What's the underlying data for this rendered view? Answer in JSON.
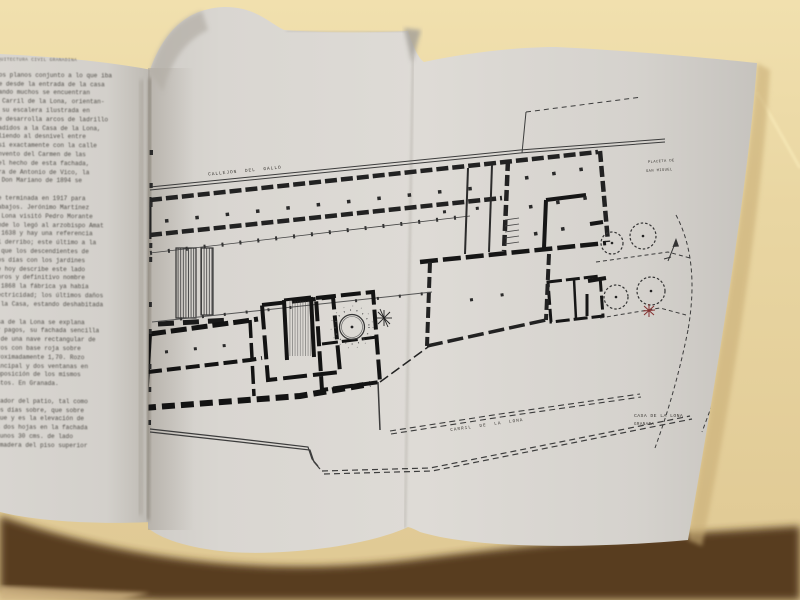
{
  "palette": {
    "table_beige": "#e9d6a2",
    "table_beige_light": "#f0dfae",
    "table_beige_dark": "#cdb181",
    "page_white": "#d8d5d0",
    "page_shadow_brown": "#4e3119",
    "ink": "#1f1f1f",
    "plan_thin_line": "#3c3c3c",
    "red_mark": "#833030"
  },
  "left_page": {
    "running_header": "ARQUITECTURA CIVIL GRANADINA",
    "paragraphs": [
      [
        "chos planos conjunto a lo que iba",
        "que desde la entrada de la casa",
        "cuando muchos se encuentran",
        "al Carril de la Lona, orientan-",
        "do su escalera ilustrada en",
        "que desarrolla arcos de ladrillo",
        "añadidos a la Casa de la Lona,",
        "saliendo al desnivel entre",
        "casi exactamente con la calle",
        "convento del Carmen de las",
        "y el hecho de esta fachada,",
        "obra de Antonio de Vico, la",
        "de Don Mariano de 1894 se"
      ],
      [
        "fue terminada en 1917 para",
        "trabajos. Jerónimo Martínez",
        "la Lona visitó Pedro Morante",
        "donde lo legó al arzobispo Amat",
        "de 1638 y hay una referencia",
        "del derribo; este último a la",
        "en que los descendientes de",
        "unos días con los jardines",
        "que hoy describe este lado",
        "libros y definitivo nombre",
        "de 1868 la fábrica ya había",
        "electricidad; los últimos daños",
        "de la Casa, estando deshabitada"
      ],
      [
        "Casa de la Lona se explana",
        "por pagos, su fachada sencilla",
        "es de una nave rectangular de",
        "muros con base roja sobre",
        "aproximadamente 1,70. Rozo",
        "principal y dos ventanas en",
        "composición de los mismos",
        "restos. En Granada."
      ],
      [
        "mirador del patio, tal como",
        "esos días sobre, que sobre",
        "sigue y es la elevación de",
        "las dos hojas en la fachada",
        "de unos 30 cms. de lado",
        "la madera del piso superior"
      ]
    ]
  },
  "plan": {
    "labels": {
      "top_street": "CALLEJON DEL GALLO",
      "upper_right_line1": "PLACETA DE",
      "upper_right_line2": "SAN MIGUEL",
      "bottom_street": "CARRIL DE LA LONA",
      "title_line1": "CASA DE LA LONA",
      "title_line2": "GRANADA"
    }
  }
}
